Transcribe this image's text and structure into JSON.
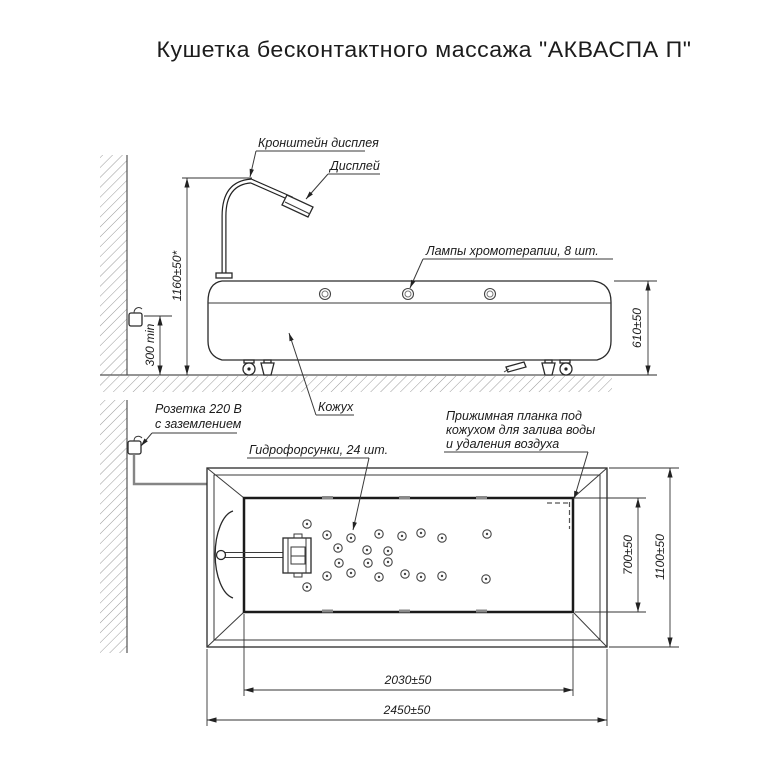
{
  "title": "Кушетка бесконтактного массажа \"АКВАСПА П\"",
  "side_view": {
    "labels": {
      "display_bracket": "Кронштейн дисплея",
      "display": "Дисплей",
      "lamps": "Лампы хромотерапии, 8 шт.",
      "casing": "Кожух",
      "socket_line1": "Розетка 220 В",
      "socket_line2": "с заземлением"
    },
    "dims": {
      "height_to_display_top": "1160±50*",
      "socket_min_height": "300 min",
      "couch_height": "610±50"
    },
    "lamp_xs": [
      325,
      408,
      490
    ]
  },
  "plan_view": {
    "labels": {
      "nozzles": "Гидрофорсунки, 24 шт.",
      "pressure_bar": [
        "Прижимная планка под",
        "кожухом для залива воды",
        "и удаления воздуха"
      ]
    },
    "dims": {
      "basin_length": "2030±50",
      "overall_length": "2450±50",
      "basin_width": "700±50",
      "overall_width": "1100±50"
    },
    "nozzles_xy": [
      [
        307,
        524
      ],
      [
        327,
        535
      ],
      [
        351,
        538
      ],
      [
        379,
        534
      ],
      [
        402,
        536
      ],
      [
        421,
        533
      ],
      [
        442,
        538
      ],
      [
        487,
        534
      ],
      [
        338,
        548
      ],
      [
        367,
        550
      ],
      [
        388,
        551
      ],
      [
        339,
        563
      ],
      [
        368,
        563
      ],
      [
        388,
        562
      ],
      [
        327,
        576
      ],
      [
        351,
        573
      ],
      [
        379,
        577
      ],
      [
        405,
        574
      ],
      [
        421,
        577
      ],
      [
        442,
        576
      ],
      [
        486,
        579
      ],
      [
        307,
        587
      ]
    ],
    "rim_tick_xs": [
      322,
      399,
      476
    ]
  }
}
